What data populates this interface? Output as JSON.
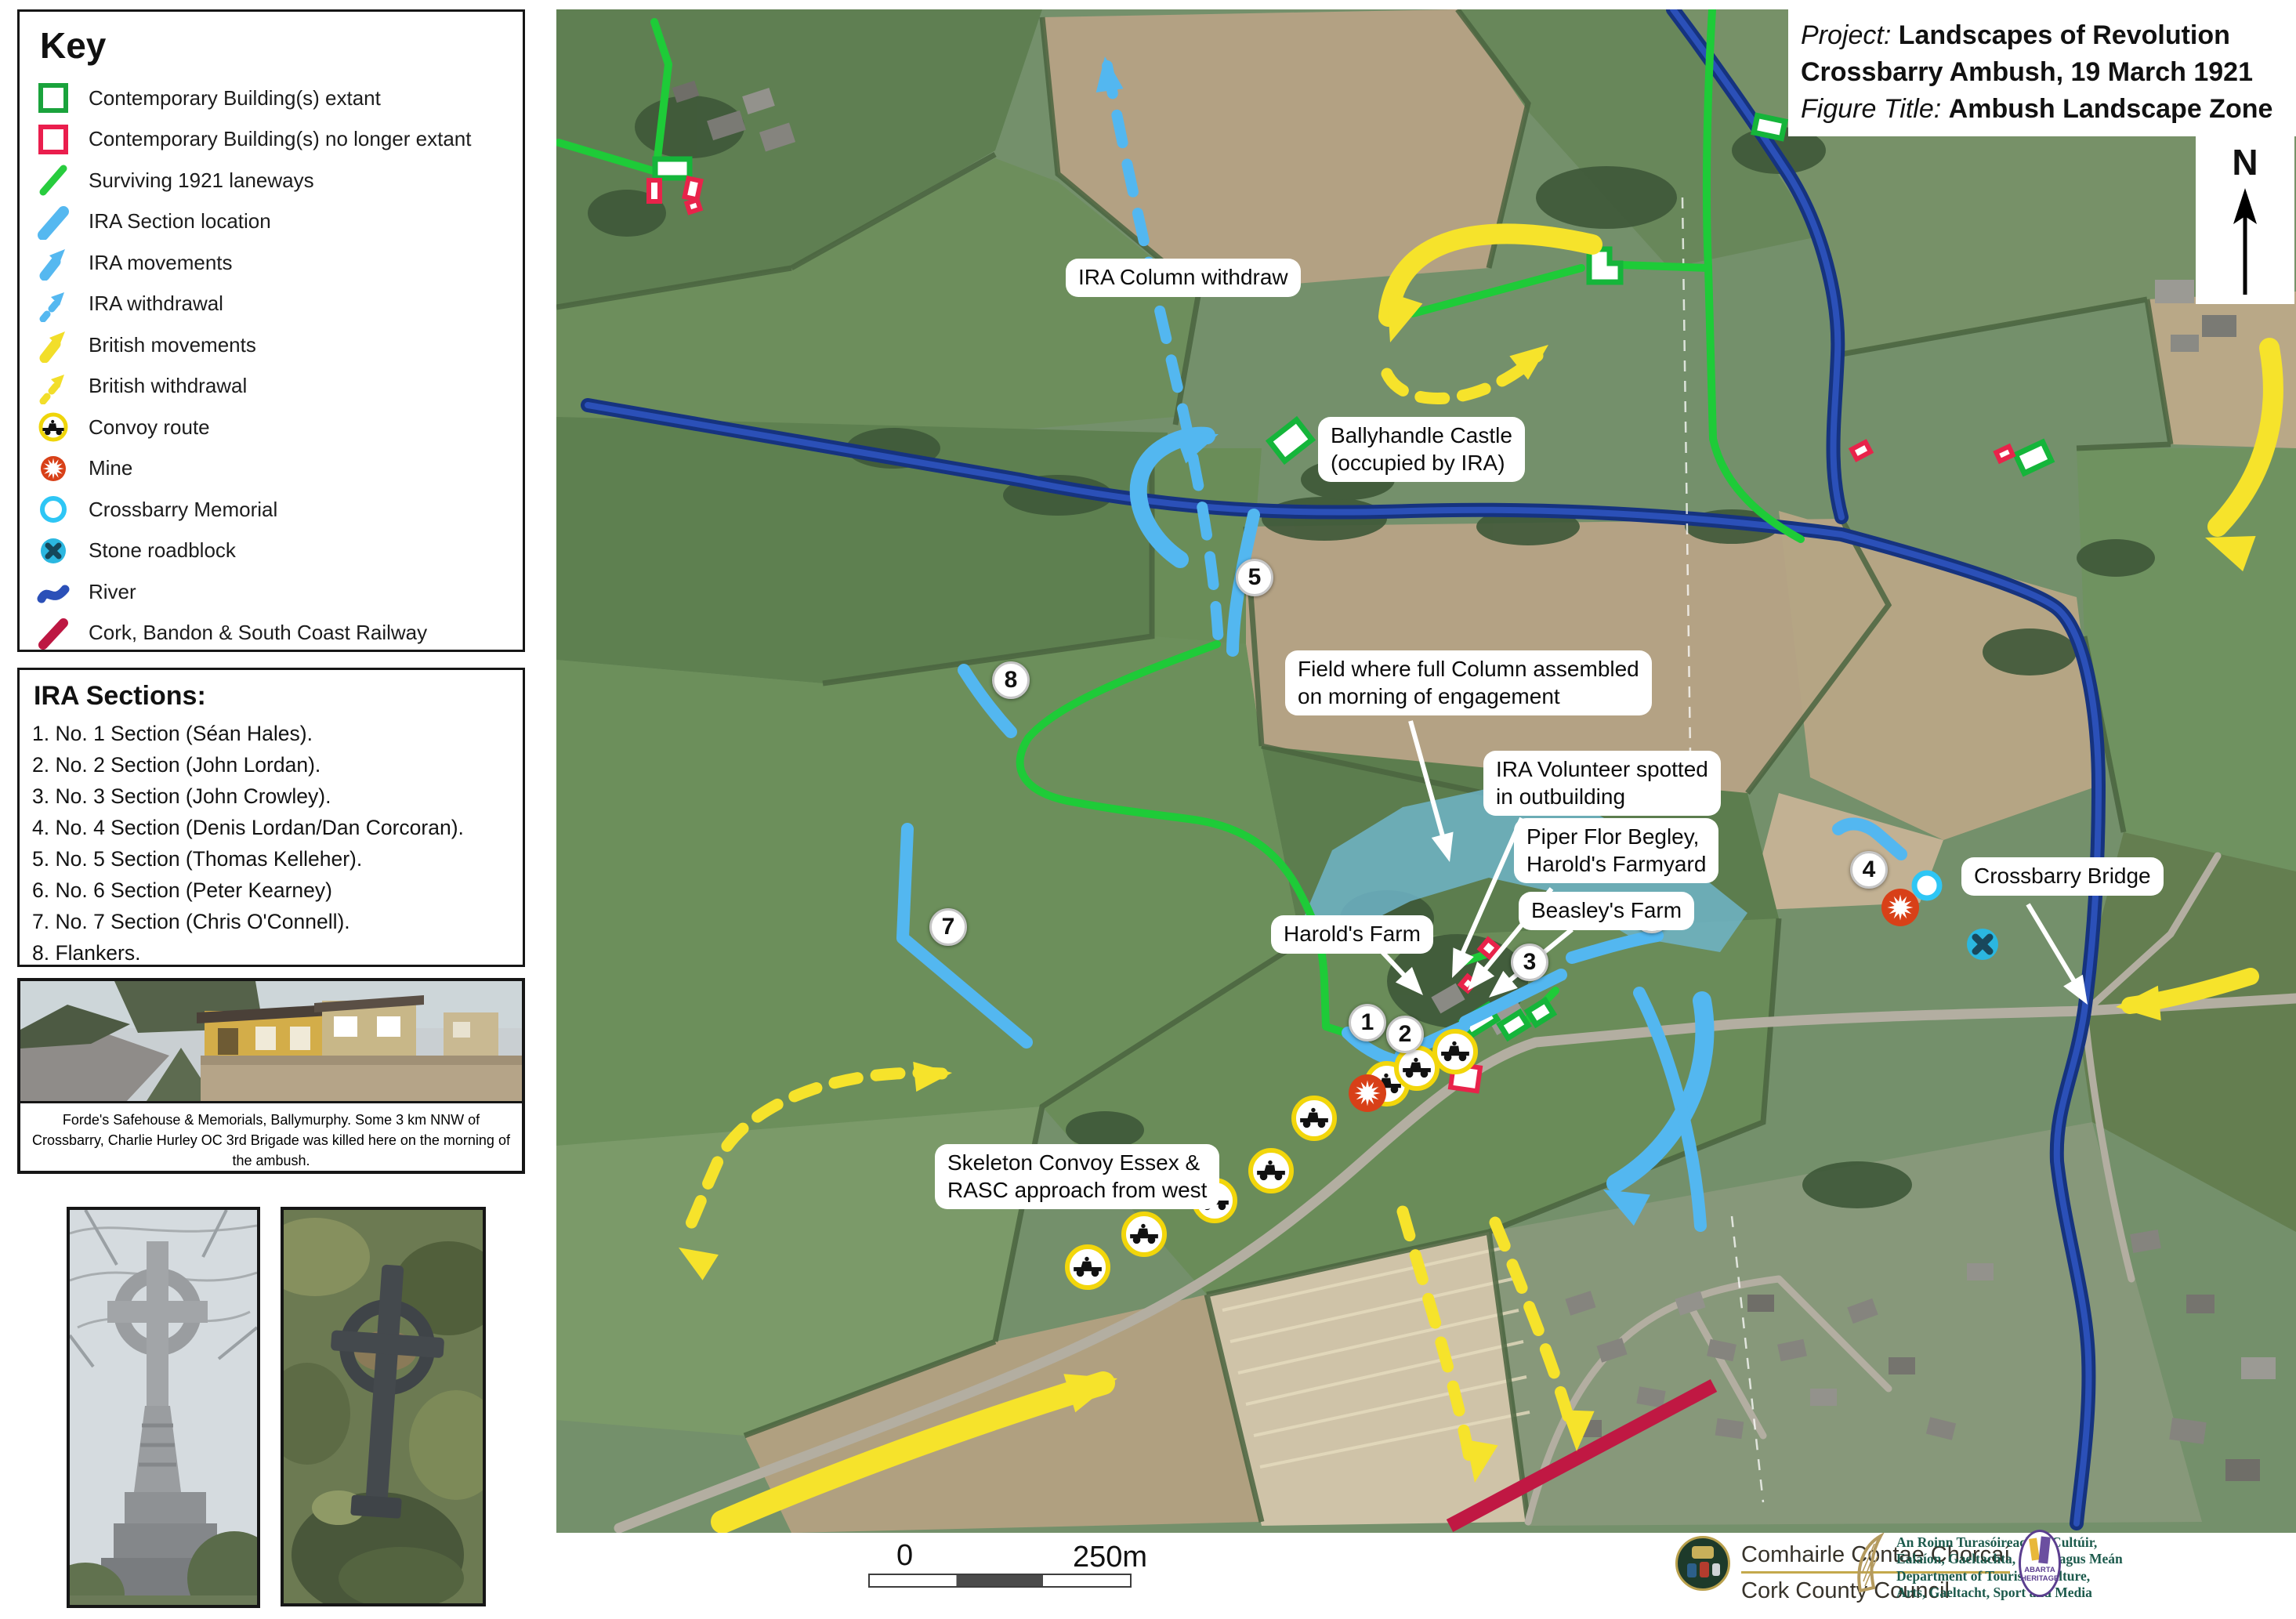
{
  "title_block": {
    "project_label": "Project:",
    "project_title": "Landscapes of Revolution",
    "subtitle": "Crossbarry Ambush, 19 March 1921",
    "figure_label": "Figure Title:",
    "figure_title": "Ambush Landscape Zone"
  },
  "key": {
    "title": "Key",
    "items": [
      {
        "label": "Contemporary Building(s) extant",
        "icon": "green-square-icon"
      },
      {
        "label": "Contemporary Building(s) no longer extant",
        "icon": "red-square-icon"
      },
      {
        "label": "Surviving 1921 laneways",
        "icon": "green-line-icon"
      },
      {
        "label": "IRA Section location",
        "icon": "blue-line-icon"
      },
      {
        "label": "IRA movements",
        "icon": "blue-arrow-icon"
      },
      {
        "label": "IRA withdrawal",
        "icon": "blue-dashed-arrow-icon"
      },
      {
        "label": "British movements",
        "icon": "yellow-arrow-icon"
      },
      {
        "label": "British withdrawal",
        "icon": "yellow-dashed-arrow-icon"
      },
      {
        "label": "Convoy route",
        "icon": "convoy-icon"
      },
      {
        "label": "Mine",
        "icon": "mine-icon"
      },
      {
        "label": "Crossbarry Memorial",
        "icon": "memorial-icon"
      },
      {
        "label": "Stone roadblock",
        "icon": "roadblock-icon"
      },
      {
        "label": "River",
        "icon": "river-icon"
      },
      {
        "label": "Cork, Bandon & South Coast Railway",
        "icon": "railway-icon"
      }
    ]
  },
  "ira_sections": {
    "title": "IRA Sections:",
    "items": [
      "1. No. 1 Section (Séan Hales).",
      "2. No. 2 Section (John Lordan).",
      "3. No. 3 Section (John Crowley).",
      "4. No. 4 Section (Denis Lordan/Dan Corcoran).",
      "5. No. 5 Section (Thomas Kelleher).",
      "6. No. 6 Section (Peter Kearney)",
      "7. No. 7 Section (Chris O'Connell).",
      "8. Flankers."
    ]
  },
  "photos": {
    "safehouse_caption": "Forde's Safehouse & Memorials, Ballymurphy. Some 3 km NNW of Crossbarry, Charlie Hurley OC 3rd Brigade was killed here on the morning of the ambush."
  },
  "map": {
    "north_label": "N",
    "markers": [
      "1",
      "2",
      "3",
      "4",
      "5",
      "6",
      "7",
      "8"
    ],
    "callouts": {
      "ira_column_withdraw": {
        "lines": [
          "IRA Column withdraw"
        ]
      },
      "ballyhandle_castle": {
        "lines": [
          "Ballyhandle Castle",
          "(occupied by IRA)"
        ]
      },
      "assembly_field": {
        "lines": [
          "Field where  full Column assembled",
          "on morning of engagement"
        ]
      },
      "volunteer_spotted": {
        "lines": [
          "IRA Volunteer spotted",
          "in outbuilding"
        ]
      },
      "piper_begley": {
        "lines": [
          "Piper Flor Begley,",
          "Harold's Farmyard"
        ]
      },
      "beasleys_farm": {
        "lines": [
          "Beasley's Farm"
        ]
      },
      "harolds_farm": {
        "lines": [
          "Harold's Farm"
        ]
      },
      "crossbarry_bridge": {
        "lines": [
          "Crossbarry Bridge"
        ]
      },
      "convoy_approach": {
        "lines": [
          "Skeleton Convoy Essex &",
          "RASC approach from west"
        ]
      }
    },
    "scale_bar": {
      "start": "0",
      "end": "250m"
    }
  },
  "footer": {
    "cork_council_irish": "Comhairle Contae Chorcaí",
    "cork_council_english": "Cork County Council",
    "department_lines": [
      "An Roinn Turasóireachta, Cultúir,",
      "Ealaíon, Gaeltachta, Spóirt agus Meán",
      "Department of Tourism, Culture,",
      "Arts, Gaeltacht, Sport and Media"
    ],
    "abarta_lines": [
      "ABARTA",
      "HERITAGE"
    ]
  },
  "colors": {
    "laneway_green": "#1ecb38",
    "building_extant_green": "#15b53a",
    "building_gone_red": "#e8234a",
    "ira_blue": "#53b7f0",
    "british_yellow": "#f6e32b",
    "river_blue": "#16337f",
    "railway_crimson": "#c01843",
    "mine_orange": "#d84018",
    "memorial_cyan": "#2ec6f5",
    "roadblock_blue": "#2bb7e0",
    "assembly_field_cyan": "#6fb4c8"
  }
}
